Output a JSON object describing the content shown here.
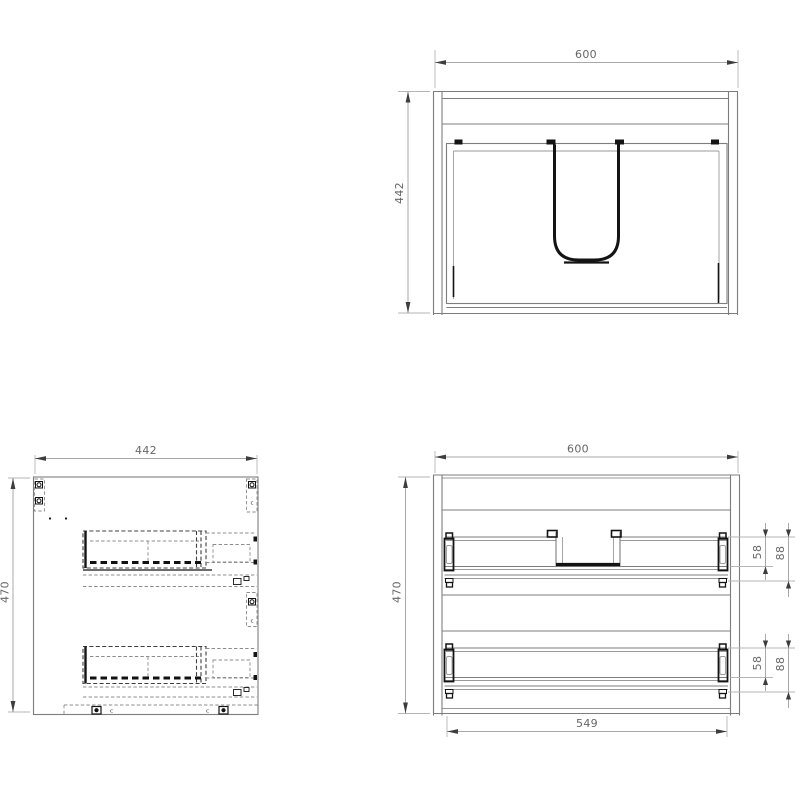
{
  "document": {
    "kind": "cad-technical-drawing",
    "subject": "vanity cabinet with two drawers, three orthographic views",
    "background": "#ffffff"
  },
  "top_view": {
    "dim_width": "600",
    "dim_depth": "442"
  },
  "side_view": {
    "dim_depth": "442",
    "dim_height": "470",
    "hardware_mark": "c"
  },
  "front_view": {
    "dim_width": "600",
    "dim_height": "470",
    "dim_inner_width": "549",
    "upper_drawer": {
      "dim_rail_offset": "58",
      "dim_total_offset": "88"
    },
    "lower_drawer": {
      "dim_rail_offset": "58",
      "dim_total_offset": "88"
    }
  },
  "colors": {
    "structure_line": "#7d7d7d",
    "inner_line": "#9a9a9a",
    "detail_line": "#141414",
    "hidden_line": "#3f3f3f",
    "dimension_line": "#a8a8a8",
    "arrow": "#3d3d3d",
    "dimension_text": "#666666"
  }
}
